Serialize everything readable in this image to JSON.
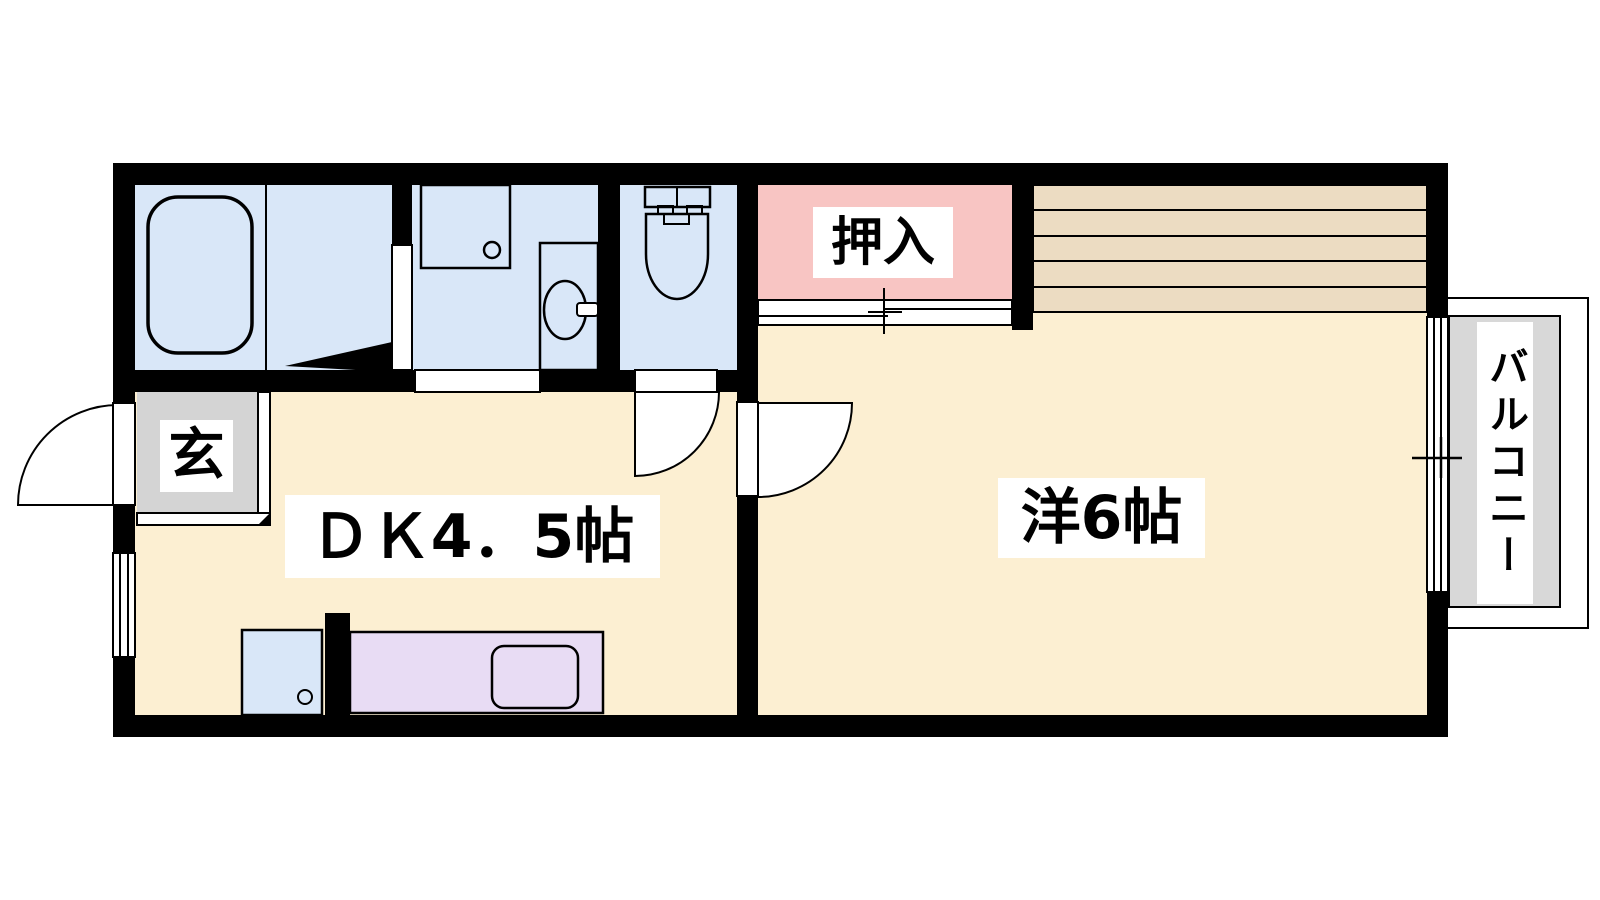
{
  "rooms": {
    "entrance": {
      "label": "玄"
    },
    "dining_kitchen": {
      "label": "ＤＫ4．5帖"
    },
    "closet": {
      "label": "押入"
    },
    "western_room": {
      "label": "洋6帖"
    },
    "balcony": {
      "label": "バルコニー"
    }
  },
  "palette": {
    "wall": "#000000",
    "line": "#000000",
    "bg": "#ffffff",
    "room_cream": "#fcefd2",
    "wet_blue": "#d9e7f8",
    "closet_pink": "#f8c5c3",
    "loft_tan": "#ecdcc2",
    "counter_lavender": "#e8dcf4",
    "entry_gray": "#d4d4d4",
    "balcony_gray": "#d8d8d8"
  }
}
